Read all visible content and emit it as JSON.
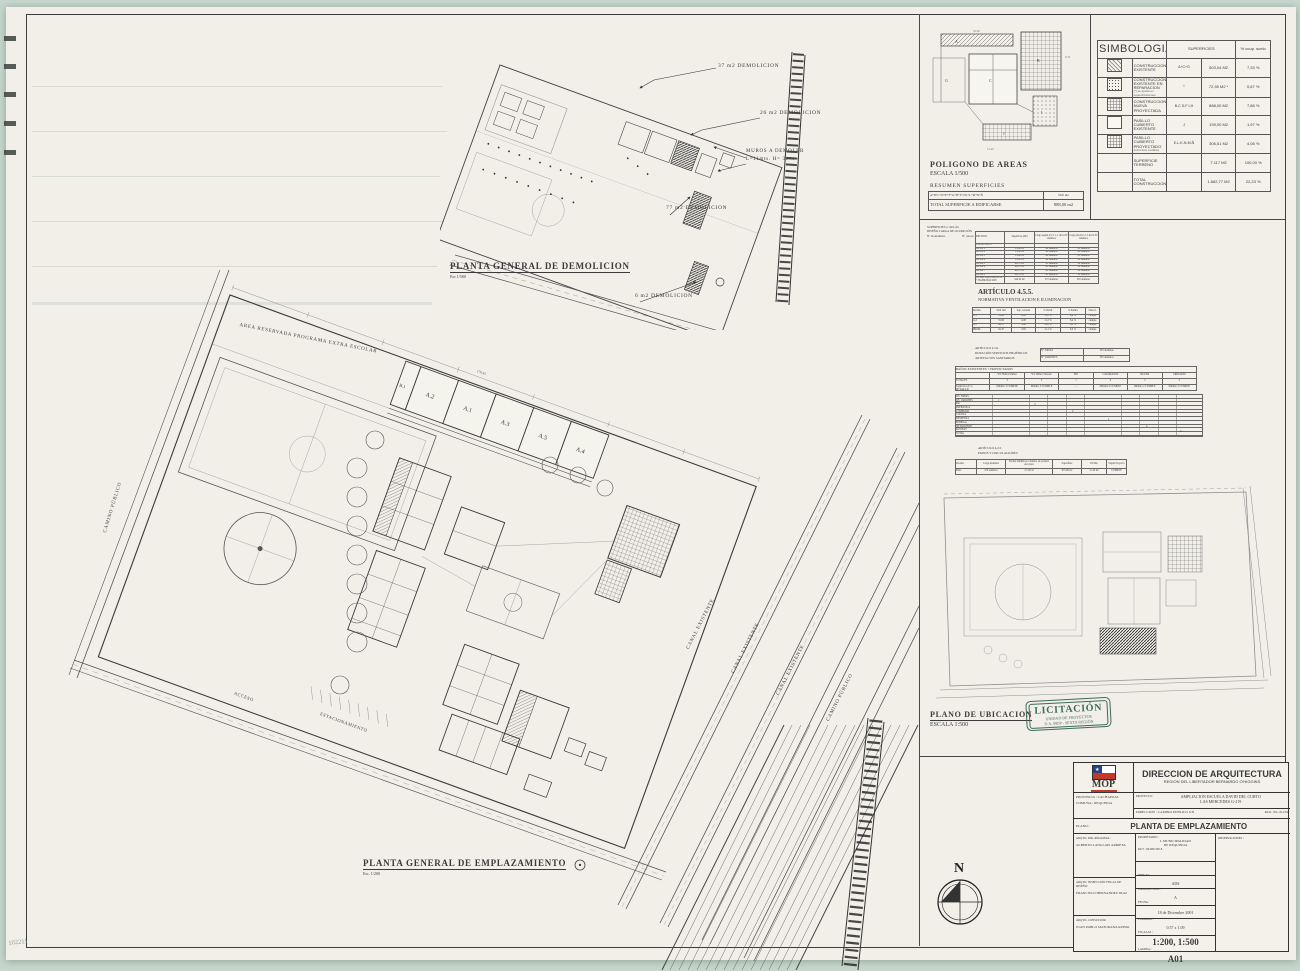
{
  "demolition": {
    "title": "PLANTA GENERAL DE DEMOLICION",
    "scale": "Esc 1/500",
    "labels": {
      "l37": "37 m2 DEMOLICION",
      "l26": "26 m2 DEMOLICION",
      "muros1": "MUROS A DEMOLER",
      "muros2": "L=11mts. H= 3mts",
      "l77": "77 m2 DEMOLICION",
      "l6": "6 m2 DEMOLICION"
    }
  },
  "poligono": {
    "title": "POLIGONO DE AREAS",
    "scale": "ESCALA 1/500",
    "resumen": "RESUMEN SUPERFICIES",
    "formula": "A+B+C+D+E+F+G+H+I+J+K+L+M+N+Ñ",
    "formula_unit": "SUP. m2",
    "total_label": "TOTAL SUPERFICIE A EDIFICARSE",
    "total_value": "888,00 m2"
  },
  "simbologia": {
    "title": "SIMBOLOGIA",
    "col_sup": "SUPERFICIES",
    "col_pct": "% ocup. suelo",
    "rows": [
      {
        "swatch": "sw-diag",
        "label": "CONSTRUCCION EXISTENTE",
        "note": "",
        "code": "A+C+G",
        "area": "503,04 M2",
        "pct": "7,33 %"
      },
      {
        "swatch": "sw-dots",
        "label": "CONSTRUCCION EXISTENTE EN REPARACION",
        "note": "(*) se ajusta en especificaciones",
        "code": "I",
        "area": "72,45 M2 *",
        "pct": "0,67 %"
      },
      {
        "swatch": "sw-grid",
        "label": "CONSTRUCCION NUEVA PROYECTADA",
        "note": "",
        "code": "B-C D-F I-H",
        "area": "888,00 M2",
        "pct": "7,88 %"
      },
      {
        "swatch": "sw-blank",
        "label": "PASILLO CUBIERTO EXISTENTE",
        "note": "",
        "code": "J",
        "area": "139,00 M2",
        "pct": "1,97 %"
      },
      {
        "swatch": "sw-grid",
        "label": "PASILLO CUBIERTO PROYECTADO",
        "note": "estructura metálica",
        "code": "E-L-K-N-M-Ñ",
        "area": "306,51 M2",
        "pct": "4,08 %"
      },
      {
        "swatch": "sw-none",
        "label": "SUPERFICIE TERRENO",
        "note": "",
        "code": "",
        "area": "7.117 M2",
        "pct": "100,00 %"
      },
      {
        "swatch": "sw-none",
        "label": "TOTAL CONSTRUCCION",
        "note": "",
        "code": "",
        "area": "1.682,77 M2",
        "pct": "22,23 %"
      }
    ]
  },
  "normativa": {
    "head1": "SUPERFICIES s/ AULAS",
    "head2": "DISEÑO CARGA DE OCUPACIÓN",
    "head3": "Nº de Alumnos",
    "head4": "Nº cursos",
    "tableA": {
      "c0": "RECINTO",
      "c1": "Superficie (M²)",
      "c2": "Carga según 4.5.5. 1,1 m²/al Nº alumnos",
      "c3": "Carga efectiva 1,3 m²/al Nº alumnos",
      "rows": [
        [
          "EXISTENTES",
          "",
          "",
          ""
        ],
        [
          "AULA 1",
          "53,86 m²",
          "48 alumnos",
          "41 alumnos"
        ],
        [
          "AULA 2",
          "53,86 m²",
          "48 alumnos",
          "41 alumnos"
        ],
        [
          "AULA 3",
          "53,86 m²",
          "48 alumnos",
          "41 alumnos"
        ],
        [
          "AULA 4",
          "53,86 m²",
          "48 alumnos",
          "41 alumnos"
        ],
        [
          "AULA 5",
          "49,70 m²",
          "45 alumnos",
          "38 alumnos"
        ],
        [
          "AULA 6",
          "49,70 m²",
          "45 alumnos",
          "38 alumnos"
        ],
        [
          "AULA 7",
          "49,70 m²",
          "45 alumnos",
          "38 alumnos"
        ],
        [
          "AULA 8",
          "49,70 m²",
          "45 alumnos",
          "38 alumnos"
        ],
        [
          "TOTAL EQUIVALENTE + HABILITACION",
          "414,24 m²",
          "372 alumnos",
          "316 alumnos"
        ]
      ]
    },
    "articulo": "ARTÍCULO 4.5.5.",
    "articulo_sub": "NORMATIVA VENTILACION E ILUMINACION",
    "tableB": {
      "cols": [
        "Recinto",
        "SUP. M2",
        "Sup. ventana",
        "% Ventil.",
        "% Ilumin.",
        "Observ."
      ],
      "rows": [
        [
          "A.1",
          "53,86",
          "6,08",
          "11,2 %",
          "8,4 %",
          "cumple"
        ],
        [
          "A.2",
          "53,86",
          "6,08",
          "11,2 %",
          "8,4 %",
          "cumple"
        ],
        [
          "A.3",
          "49,70",
          "5,40",
          "10,8 %",
          "8,1 %",
          "cumple"
        ],
        [
          "PROM.",
          "52,47",
          "5,85",
          "11,1 %",
          "8,3 %",
          "cumple"
        ]
      ]
    },
    "head5": "ARTÍCULO 4.5.6.",
    "head6": "DOTACIÓN SERVICIOS HIGIÉNICOS",
    "head7": "ARTEFACTOS SANITARIOS",
    "ninas_label": "Nº NIÑAS",
    "ninas": "135 alumnas",
    "varones_label": "Nº VARONES",
    "varones": "135 alumnos",
    "tableC": {
      "title": "BAÑOS EXISTENTES + PROYECTADOS",
      "cols": [
        "",
        "WC Baños Damas",
        "WC Baños Varones",
        "BD",
        "LAVAMANOS",
        "DUCHA",
        "URINARIO"
      ],
      "rows": [
        [
          "TOTALES",
          "3",
          "3",
          "1",
          "6",
          "2",
          "2"
        ],
        [
          "Según O.G.U.C.",
          "Mínimo 3 CUMPLE",
          "Mínimo 3 CUMPLE",
          "—",
          "Mínimo 6 CUMPLE",
          "Mínimo 2 CUMPLE",
          "Mínimo 2 CUMPLE"
        ]
      ]
    },
    "tableD": {
      "title": "DETALLE",
      "rows": [
        "WC NIÑAS",
        "WC VARONES",
        "BD",
        "PREBASICA",
        "COMEDOR",
        "COCINA",
        "DESPENSA",
        "BODEGA",
        "SH DOCENTE",
        "DUCHAS",
        "TOTAL"
      ],
      "marks": {
        "m1": "1",
        "m2": "3",
        "m3": "2",
        "m4": "1",
        "m5": "4",
        "m6": "3"
      }
    },
    "head8": "ARTÍCULO 4.2.5.",
    "head9": "PATIOS Y CIRCULACIONES",
    "tableE": {
      "cols": [
        "Recinto",
        "Carga Alumnos",
        "Norma mínima por alumno en recintos escolares",
        "Superficie",
        "TOTAL",
        "Según Proyecto"
      ],
      "rows": [
        [
          "Patio",
          "270 alumnos",
          "2,5 m²/al",
          "675,00 m²",
          "1.120 m²",
          "CUMPLE"
        ]
      ]
    }
  },
  "ubicacion": {
    "title": "PLANO DE UBICACION",
    "scale": "ESCALA 1:500"
  },
  "stamp": {
    "line1": "LICITACIÓN",
    "line2": "UNIDAD DE PROYECTOS",
    "line3": "D.A. MOP - SEXTA REGIÓN",
    "color": "#3f6b57"
  },
  "main": {
    "title": "PLANTA GENERAL DE EMPLAZAMIENTO",
    "scale": "Esc. 1/200",
    "area_reservada": "AREA RESERVADA PROGRAMA EXTRA ESCOLAR",
    "camino_left": "CAMINO PÚBLICO",
    "camino_right": "CAMINO PÚBLICO",
    "canales": [
      "CANAL EXISTENTE",
      "CANAL EXISTENTE",
      "CANAL EXISTENTE"
    ],
    "rooms": [
      "B.1",
      "A.2",
      "A.1",
      "A.3",
      "A.5",
      "A.4"
    ],
    "dim_top": "170.85",
    "estacionamiento": "ESTACIONAMIENTO",
    "acceso": "ACCESO",
    "north": "N"
  },
  "titleblock": {
    "mop": "MOP",
    "org": "DIRECCION DE ARQUITECTURA",
    "org_sub": "REGION DEL LIBERTADOR BERNARDO O'HIGGINS",
    "provincia_label": "PROVINCIA :",
    "provincia": "CACHAPOAL",
    "comuna_label": "COMUNA :",
    "comuna": "REQUINOA",
    "proyecto_label": "PROYECTO :",
    "proyecto_l1": "AMPLIACION ESCUELA DAVID DEL CURTO",
    "proyecto_l2": "LAS MERCEDES G-219",
    "direccion_label": "DIRECCION :",
    "direccion": "CAMINO PUBLICO S/N",
    "rol": "ROL. 99-19-219",
    "plano_label": "PLANO :",
    "plano": "PLANTA DE EMPLAZAMIENTO",
    "arq1_label": "ARQTO. DIR. REGIONAL:",
    "arq1": "ALBERTO LANGLAIS ARRIETA",
    "arq2_label": "ARQTO. INSPECCIÓN FISCAL DE DISEÑO:",
    "arq2": "FRANCISCO HERNANDEZ DIAZ",
    "arq3_label": "ARQTO. CONSULTOR:",
    "arq3": "JUAN PABLO MATURANA RUBIO",
    "prop_label": "PROPIETARIO :",
    "prop1": "I. MUNICIPALIDAD",
    "prop2": "DE REQUINOA",
    "rut": "RUT : 69.080.300-8",
    "dibujo_label": "DIBUJO :",
    "dibujo": "ADS",
    "lamclave_label": "LAMINA CLAVE :",
    "lamclave": "A",
    "fecha_label": "FECHA :",
    "fecha": "18 de Diciembre 2001",
    "formato_label": "FORMATO :",
    "formato": "0.57 x 1.09",
    "escalas_label": "ESCALAS :",
    "escalas": "1:200, 1:500",
    "lamina_label": "LAMINA :",
    "lamina": "A01",
    "obs_label": "OBSERVACIONES :"
  },
  "corner_note": "102211"
}
